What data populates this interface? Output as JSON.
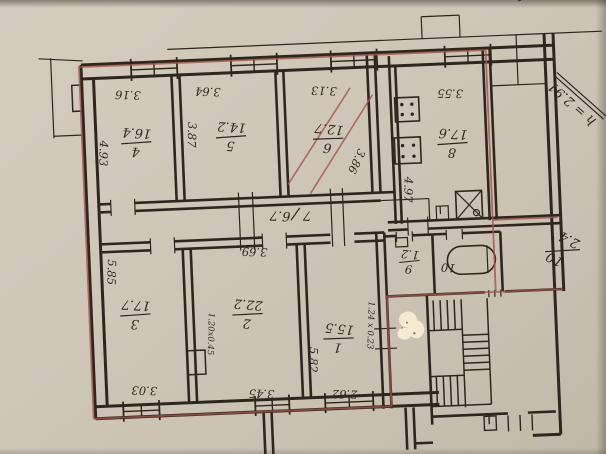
{
  "document": {
    "kind_label": "apartment floor plan (scanned, rotated 180°)"
  },
  "palette": {
    "paper": "#cdc6b7",
    "ink": "#2d2720",
    "red_pencil": "#a3524a",
    "whiteout": "#f3ebd2"
  },
  "annotations": {
    "ceiling_height": "h = 2.91",
    "bath_fraction_numerator": "10",
    "bath_fraction_denominator": "2.4"
  },
  "rooms": [
    {
      "number": "1",
      "area": "15.5",
      "dim_side": "5.82",
      "dim_bottom": "2.62",
      "note": "1.24 x 0.23"
    },
    {
      "number": "2",
      "area": "22.2",
      "dim_top": "3.69",
      "dim_bottom": "3.45",
      "note": "1.20x0.45"
    },
    {
      "number": "3",
      "area": "17.7",
      "dim_side": "5.85",
      "dim_bottom": "3.03"
    },
    {
      "number": "4",
      "area": "16.4",
      "dim_side": "4.93",
      "dim_top": "3.16"
    },
    {
      "number": "5",
      "area": "14.2",
      "dim_side": "3.87",
      "dim_top": "3.64"
    },
    {
      "number": "6",
      "area": "12.7",
      "dim_top": "3.13",
      "dim_side": "3.86"
    },
    {
      "number": "7",
      "area": "6.7"
    },
    {
      "number": "8",
      "area": "17.6",
      "dim_top": "3.55",
      "dim_side": "4.97"
    },
    {
      "number": "9",
      "area": "1.2"
    },
    {
      "number": "10"
    }
  ]
}
